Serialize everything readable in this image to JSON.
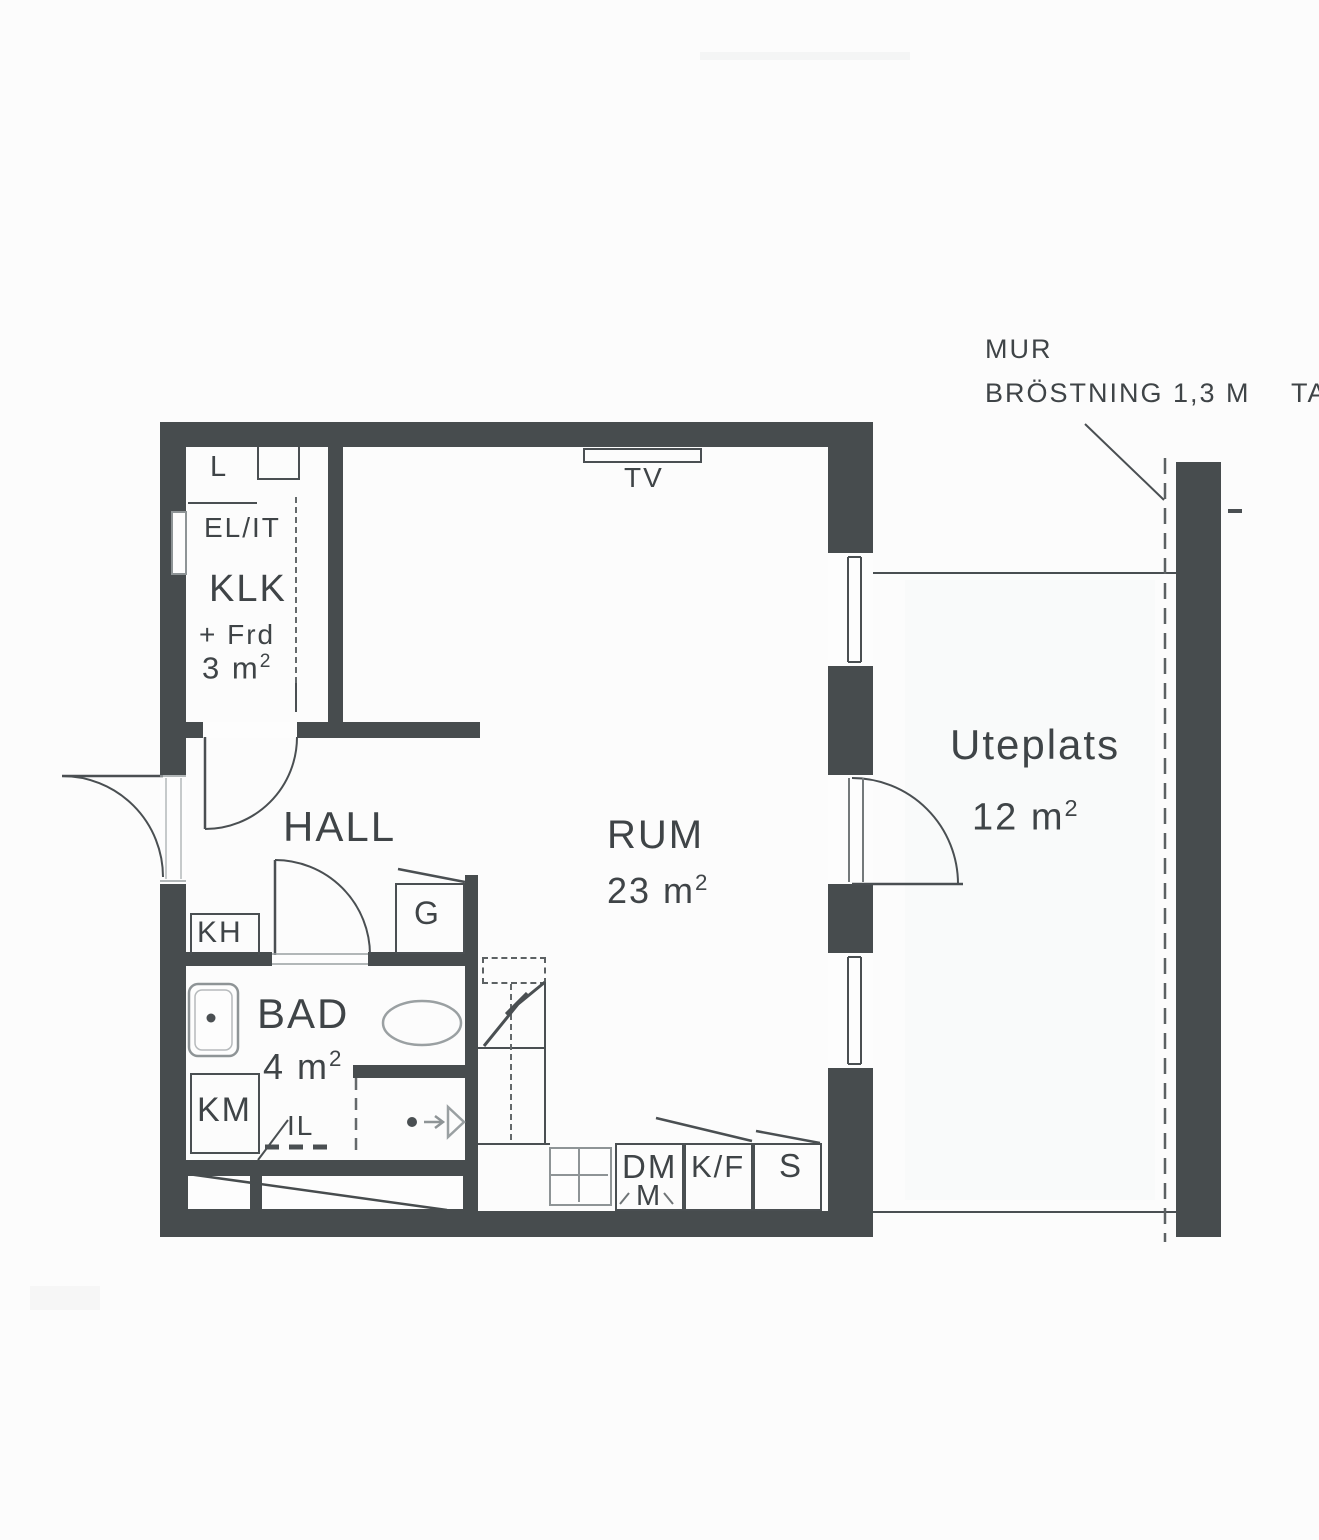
{
  "annotations": {
    "mur_line1": "MUR",
    "mur_line2": "BRÖSTNING 1,3 M",
    "ta_partial": "TA"
  },
  "rooms": {
    "klk": {
      "name": "KLK",
      "sub": "+ Frd",
      "area_val": "3 m",
      "area_sup": "2"
    },
    "hall": {
      "name": "HALL"
    },
    "rum": {
      "name": "RUM",
      "area_val": "23 m",
      "area_sup": "2"
    },
    "bad": {
      "name": "BAD",
      "area_val": "4 m",
      "area_sup": "2"
    },
    "uteplats": {
      "name": "Uteplats",
      "area_val": "12 m",
      "area_sup": "2"
    }
  },
  "fixtures": {
    "l": "L",
    "el_it": "EL/IT",
    "tv": "TV",
    "kh": "KH",
    "g": "G",
    "km": "KM",
    "il": "IL",
    "dm": "DM",
    "m": "M",
    "kf": "K/F",
    "s": "S"
  },
  "colors": {
    "wall": "#474c4e",
    "line": "#4a4f52",
    "fixture_gray": "#8e9496",
    "paper": "#fcfcfc"
  }
}
